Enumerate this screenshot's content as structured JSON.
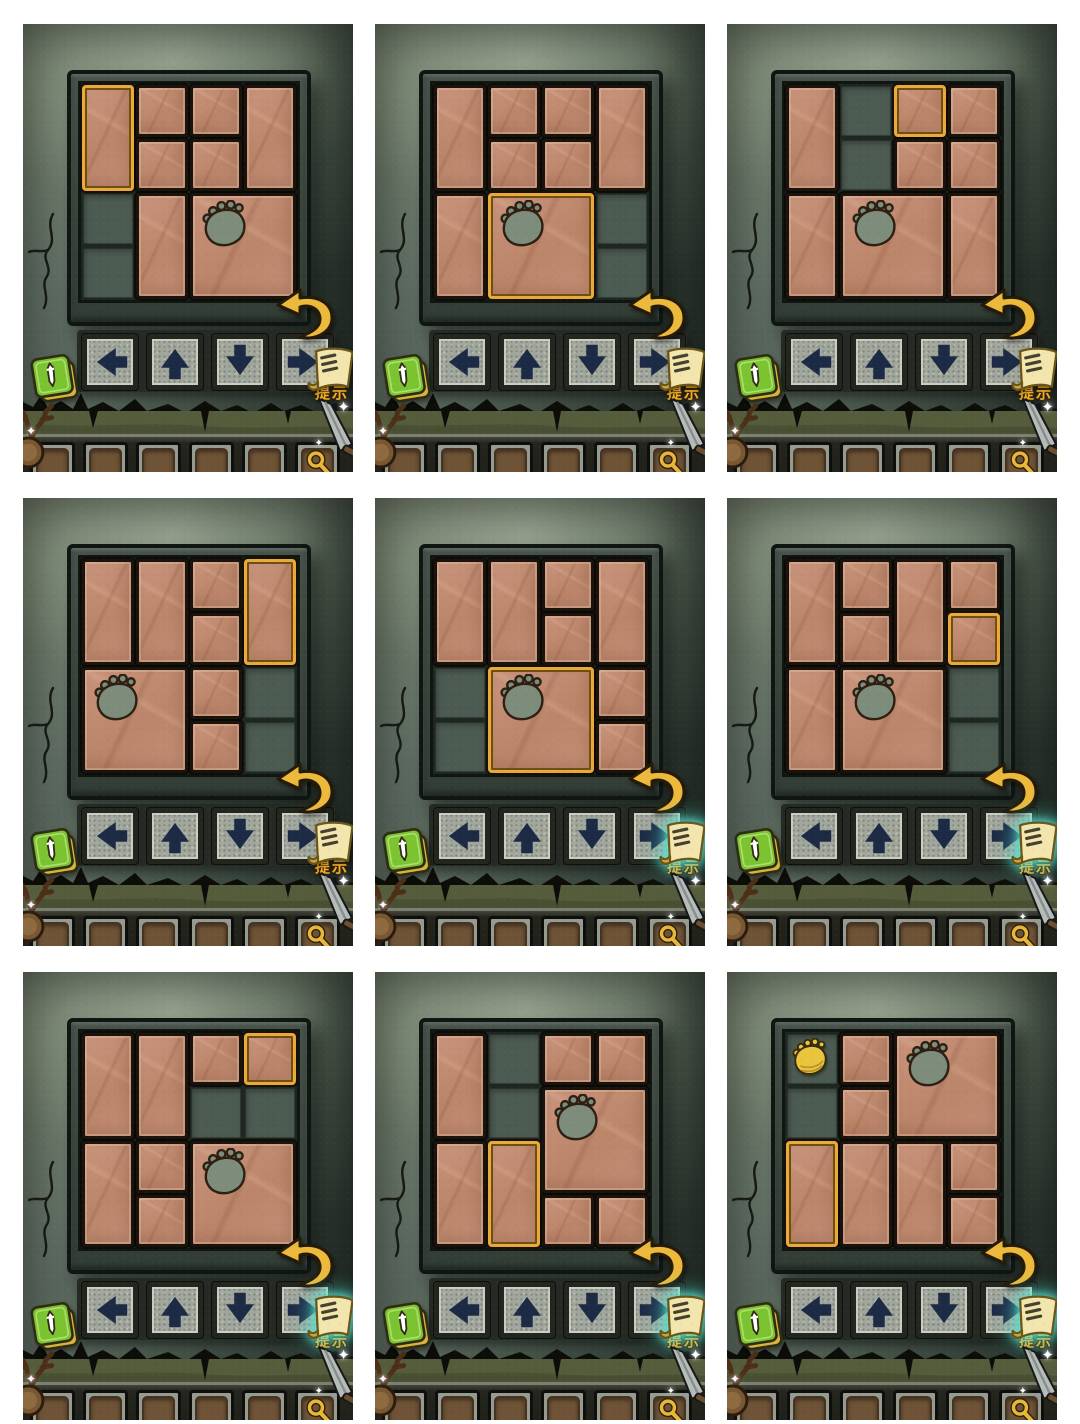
{
  "hint_label": "提示",
  "board": {
    "cols": 4,
    "rows": 4
  },
  "controls": {
    "directions": [
      "left",
      "up",
      "down",
      "right"
    ]
  },
  "inventory": {
    "slot_count": 6,
    "magnifier_in_last_slot": true
  },
  "colors": {
    "tile": "#c28d74",
    "tile_border": "#1a130c",
    "highlight_gold": "#eaa93c",
    "empty_cell": "#4c5b51",
    "board_frame": "#3d4941",
    "wall_light": "#8a9581",
    "wall_dark": "#2a342d",
    "claw": "#7e8d7b",
    "crown_gold": "#e9c53e",
    "arrow_glyph": "#1c2a45",
    "button_face": "#a2a79d",
    "undo_gold": "#ecb93c",
    "scroll_cream": "#f2e6ae",
    "hint_text": "#f3ab2b",
    "glow_teal": "#5ae8d8",
    "grass": "#555c3b",
    "inventory_bg": "#24261d",
    "slot_brown": "#6f5336",
    "book_green": "#7cc331",
    "book_gold": "#d9b43b"
  },
  "icons": [
    "spellbook-icon",
    "hint-scroll-icon",
    "undo-arrow-icon",
    "magnifier-icon",
    "claw-hole-icon",
    "crown-target-icon",
    "sword-icon",
    "antler-icon",
    "sparkle-icon",
    "arrow-left-icon",
    "arrow-up-icon",
    "arrow-down-icon",
    "arrow-right-icon"
  ],
  "panels": [
    {
      "id": 1,
      "hint_glow": false,
      "crown": null,
      "pieces": [
        {
          "type": "vertical",
          "col": 1,
          "row": 1,
          "highlighted": true
        },
        {
          "type": "small",
          "col": 2,
          "row": 1
        },
        {
          "type": "small",
          "col": 3,
          "row": 1
        },
        {
          "type": "vertical",
          "col": 4,
          "row": 1
        },
        {
          "type": "small",
          "col": 2,
          "row": 2
        },
        {
          "type": "small",
          "col": 3,
          "row": 2
        },
        {
          "type": "vertical",
          "col": 2,
          "row": 3
        },
        {
          "type": "big",
          "col": 3,
          "row": 3,
          "claw": true
        }
      ]
    },
    {
      "id": 2,
      "hint_glow": false,
      "crown": null,
      "pieces": [
        {
          "type": "vertical",
          "col": 1,
          "row": 1
        },
        {
          "type": "small",
          "col": 2,
          "row": 1
        },
        {
          "type": "small",
          "col": 3,
          "row": 1
        },
        {
          "type": "vertical",
          "col": 4,
          "row": 1
        },
        {
          "type": "small",
          "col": 2,
          "row": 2
        },
        {
          "type": "small",
          "col": 3,
          "row": 2
        },
        {
          "type": "vertical",
          "col": 1,
          "row": 3
        },
        {
          "type": "big",
          "col": 2,
          "row": 3,
          "claw": true,
          "highlighted": true
        }
      ]
    },
    {
      "id": 3,
      "hint_glow": false,
      "crown": null,
      "pieces": [
        {
          "type": "vertical",
          "col": 1,
          "row": 1
        },
        {
          "type": "small",
          "col": 3,
          "row": 1,
          "highlighted": true
        },
        {
          "type": "small",
          "col": 4,
          "row": 1
        },
        {
          "type": "small",
          "col": 3,
          "row": 2
        },
        {
          "type": "small",
          "col": 4,
          "row": 2
        },
        {
          "type": "vertical",
          "col": 1,
          "row": 3
        },
        {
          "type": "big",
          "col": 2,
          "row": 3,
          "claw": true
        },
        {
          "type": "vertical",
          "col": 4,
          "row": 3
        }
      ]
    },
    {
      "id": 4,
      "hint_glow": false,
      "crown": null,
      "pieces": [
        {
          "type": "vertical",
          "col": 1,
          "row": 1
        },
        {
          "type": "vertical",
          "col": 2,
          "row": 1
        },
        {
          "type": "small",
          "col": 3,
          "row": 1
        },
        {
          "type": "vertical",
          "col": 4,
          "row": 1,
          "highlighted": true
        },
        {
          "type": "small",
          "col": 3,
          "row": 2
        },
        {
          "type": "big",
          "col": 1,
          "row": 3,
          "claw": true
        },
        {
          "type": "small",
          "col": 3,
          "row": 3
        },
        {
          "type": "small",
          "col": 3,
          "row": 4
        }
      ]
    },
    {
      "id": 5,
      "hint_glow": true,
      "crown": null,
      "pieces": [
        {
          "type": "vertical",
          "col": 1,
          "row": 1
        },
        {
          "type": "vertical",
          "col": 2,
          "row": 1
        },
        {
          "type": "small",
          "col": 3,
          "row": 1
        },
        {
          "type": "vertical",
          "col": 4,
          "row": 1
        },
        {
          "type": "small",
          "col": 3,
          "row": 2
        },
        {
          "type": "big",
          "col": 2,
          "row": 3,
          "claw": true,
          "highlighted": true
        },
        {
          "type": "small",
          "col": 4,
          "row": 3
        },
        {
          "type": "small",
          "col": 4,
          "row": 4
        }
      ]
    },
    {
      "id": 6,
      "hint_glow": true,
      "crown": null,
      "pieces": [
        {
          "type": "vertical",
          "col": 1,
          "row": 1
        },
        {
          "type": "small",
          "col": 2,
          "row": 1
        },
        {
          "type": "vertical",
          "col": 3,
          "row": 1
        },
        {
          "type": "small",
          "col": 4,
          "row": 1
        },
        {
          "type": "small",
          "col": 2,
          "row": 2
        },
        {
          "type": "small",
          "col": 4,
          "row": 2,
          "highlighted": true
        },
        {
          "type": "vertical",
          "col": 1,
          "row": 3
        },
        {
          "type": "big",
          "col": 2,
          "row": 3,
          "claw": true
        }
      ]
    },
    {
      "id": 7,
      "hint_glow": true,
      "crown": null,
      "pieces": [
        {
          "type": "vertical",
          "col": 1,
          "row": 1
        },
        {
          "type": "vertical",
          "col": 2,
          "row": 1
        },
        {
          "type": "small",
          "col": 3,
          "row": 1
        },
        {
          "type": "small",
          "col": 4,
          "row": 1,
          "highlighted": true
        },
        {
          "type": "vertical",
          "col": 1,
          "row": 3
        },
        {
          "type": "small",
          "col": 2,
          "row": 3
        },
        {
          "type": "big",
          "col": 3,
          "row": 3,
          "claw": true
        },
        {
          "type": "small",
          "col": 2,
          "row": 4
        }
      ]
    },
    {
      "id": 8,
      "hint_glow": true,
      "crown": null,
      "pieces": [
        {
          "type": "vertical",
          "col": 1,
          "row": 1
        },
        {
          "type": "small",
          "col": 3,
          "row": 1
        },
        {
          "type": "small",
          "col": 4,
          "row": 1
        },
        {
          "type": "big",
          "col": 3,
          "row": 2,
          "claw": true
        },
        {
          "type": "vertical",
          "col": 1,
          "row": 3
        },
        {
          "type": "vertical",
          "col": 2,
          "row": 3,
          "highlighted": true
        },
        {
          "type": "small",
          "col": 3,
          "row": 4
        },
        {
          "type": "small",
          "col": 4,
          "row": 4
        }
      ]
    },
    {
      "id": 9,
      "hint_glow": true,
      "crown": {
        "col": 1,
        "row": 1
      },
      "pieces": [
        {
          "type": "small",
          "col": 2,
          "row": 1
        },
        {
          "type": "big",
          "col": 3,
          "row": 1,
          "claw": true
        },
        {
          "type": "small",
          "col": 2,
          "row": 2
        },
        {
          "type": "vertical",
          "col": 1,
          "row": 3,
          "highlighted": true
        },
        {
          "type": "vertical",
          "col": 2,
          "row": 3
        },
        {
          "type": "vertical",
          "col": 3,
          "row": 3
        },
        {
          "type": "small",
          "col": 4,
          "row": 3
        },
        {
          "type": "small",
          "col": 4,
          "row": 4
        }
      ]
    }
  ]
}
